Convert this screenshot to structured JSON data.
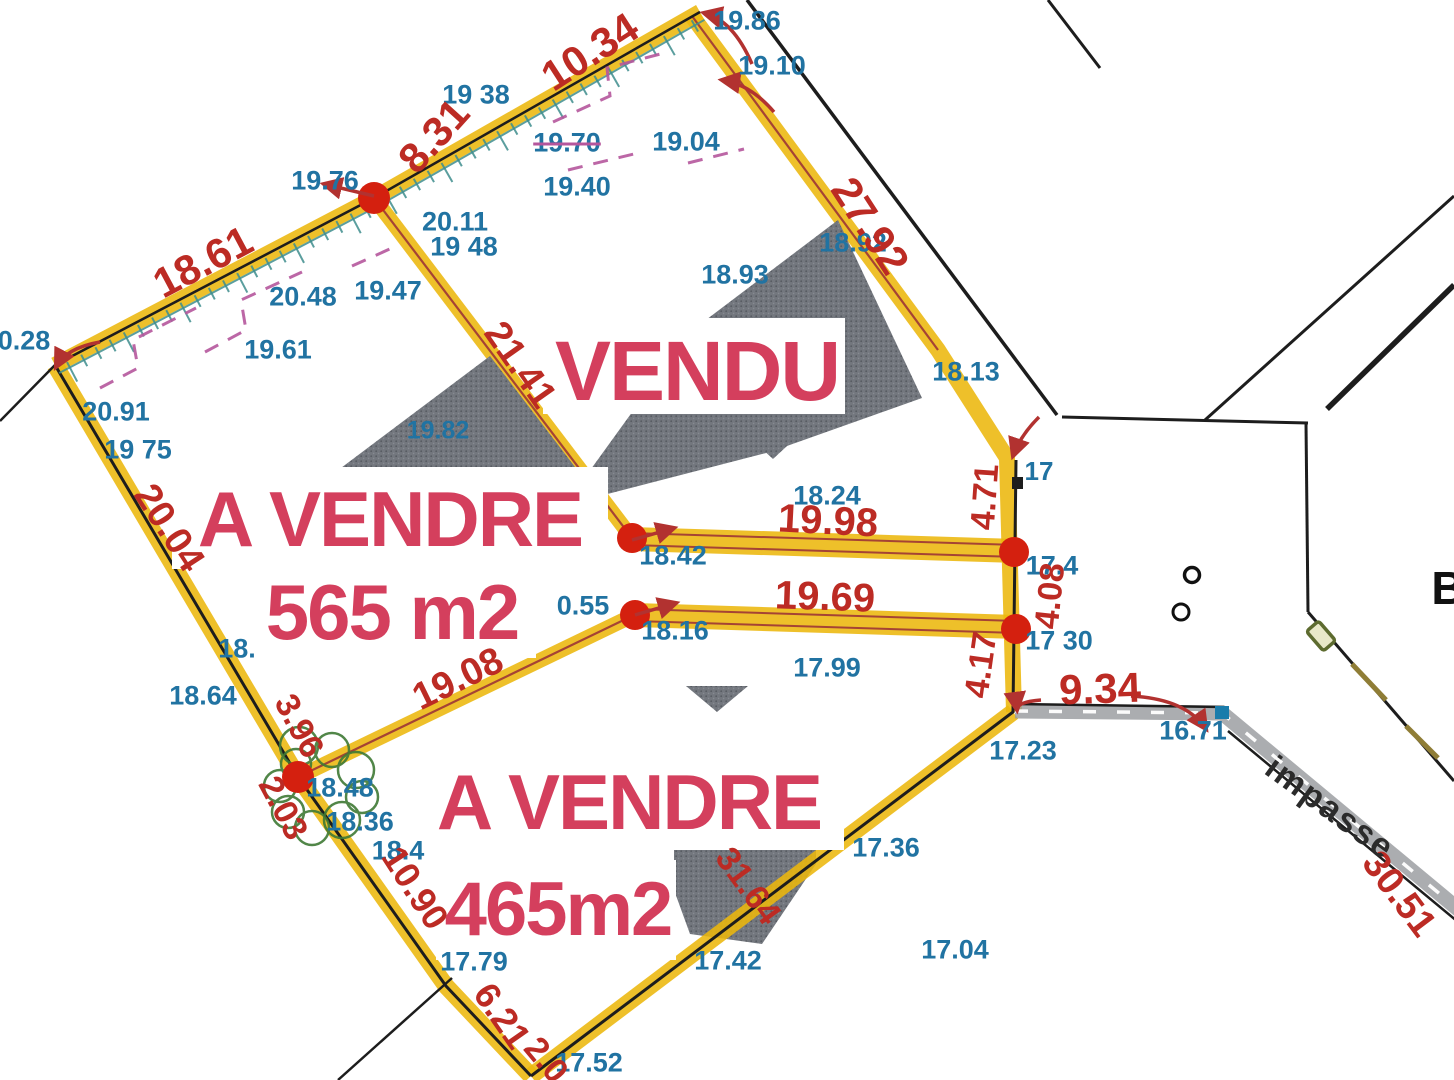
{
  "palette": {
    "boundary_yellow": "#ecb70d",
    "measure_red": "#bc2b24",
    "elevation_blue": "#2173a2",
    "overlay_pink": "#d43f5d",
    "hatch_teal": "#3f8e8e",
    "dash_magenta": "#b5569c",
    "building_gray": "#73777e",
    "road_gray": "#96999c",
    "tree_green": "#3f7a35",
    "vertex_dot_red": "#d4200f",
    "marker_blue": "#1a7cab"
  },
  "overlays": {
    "vendu": "VENDU",
    "parcel_565_status": "A VENDRE",
    "parcel_565_area": "565 m2",
    "parcel_465_status": "A VENDRE",
    "parcel_465_area": "465m2"
  },
  "street": {
    "impasse_label": "impasse",
    "edge_letter": "B"
  },
  "elevations": [
    {
      "t": "19.86",
      "x": 747,
      "y": 21
    },
    {
      "t": "19.10",
      "x": 772,
      "y": 66
    },
    {
      "t": "19 38",
      "x": 476,
      "y": 95
    },
    {
      "t": "19.70",
      "x": 567,
      "y": 143,
      "strike": true
    },
    {
      "t": "19.04",
      "x": 686,
      "y": 142
    },
    {
      "t": "19.40",
      "x": 577,
      "y": 187
    },
    {
      "t": "19.76",
      "x": 325,
      "y": 181
    },
    {
      "t": "20.11",
      "x": 455,
      "y": 222
    },
    {
      "t": "19 48",
      "x": 464,
      "y": 247
    },
    {
      "t": "20.48",
      "x": 303,
      "y": 297
    },
    {
      "t": "19.47",
      "x": 388,
      "y": 291
    },
    {
      "t": "19.61",
      "x": 278,
      "y": 350
    },
    {
      "t": "18.93",
      "x": 735,
      "y": 275
    },
    {
      "t": "18.92",
      "x": 853,
      "y": 243
    },
    {
      "t": "18.13",
      "x": 966,
      "y": 372
    },
    {
      "t": "17",
      "x": 1039,
      "y": 471,
      "s": 26
    },
    {
      "t": "20.91",
      "x": 116,
      "y": 412
    },
    {
      "t": "19 75",
      "x": 138,
      "y": 450
    },
    {
      "t": "19.82",
      "x": 438,
      "y": 431,
      "s": 25
    },
    {
      "t": "18.24",
      "x": 827,
      "y": 496
    },
    {
      "t": "18.42",
      "x": 673,
      "y": 556
    },
    {
      "t": "0.55",
      "x": 583,
      "y": 606
    },
    {
      "t": "18.16",
      "x": 675,
      "y": 631
    },
    {
      "t": "17.99",
      "x": 827,
      "y": 668
    },
    {
      "t": "17 30",
      "x": 1059,
      "y": 641
    },
    {
      "t": "17.4",
      "x": 1052,
      "y": 566
    },
    {
      "t": "18.",
      "x": 237,
      "y": 649
    },
    {
      "t": "18.64",
      "x": 203,
      "y": 696
    },
    {
      "t": "18.48",
      "x": 340,
      "y": 788
    },
    {
      "t": "18.36",
      "x": 360,
      "y": 822
    },
    {
      "t": "18.4",
      "x": 398,
      "y": 851
    },
    {
      "t": "17.79",
      "x": 474,
      "y": 962
    },
    {
      "t": "17.52",
      "x": 589,
      "y": 1063
    },
    {
      "t": "17.42",
      "x": 728,
      "y": 961
    },
    {
      "t": "17.36",
      "x": 886,
      "y": 848
    },
    {
      "t": "17.23",
      "x": 1023,
      "y": 751
    },
    {
      "t": "17.04",
      "x": 955,
      "y": 950
    },
    {
      "t": "16.71",
      "x": 1193,
      "y": 731
    },
    {
      "t": "0.28",
      "x": 24,
      "y": 341
    }
  ],
  "measurements": [
    {
      "t": "10.34",
      "x": 590,
      "y": 52,
      "r": -33,
      "s": 42
    },
    {
      "t": "8.31",
      "x": 434,
      "y": 136,
      "r": -48,
      "s": 42
    },
    {
      "t": "18.61",
      "x": 203,
      "y": 262,
      "r": -28,
      "s": 42
    },
    {
      "t": "27.92",
      "x": 870,
      "y": 226,
      "r": 57,
      "s": 42
    },
    {
      "t": "21.41",
      "x": 520,
      "y": 365,
      "r": 55,
      "s": 38
    },
    {
      "t": "19.98",
      "x": 828,
      "y": 521,
      "r": 3,
      "s": 40
    },
    {
      "t": "19.69",
      "x": 825,
      "y": 597,
      "r": 2,
      "s": 40
    },
    {
      "t": "19.08",
      "x": 458,
      "y": 679,
      "r": -26,
      "s": 38
    },
    {
      "t": "20.04",
      "x": 169,
      "y": 528,
      "r": 57,
      "s": 38
    },
    {
      "t": "4.71",
      "x": 985,
      "y": 497,
      "r": -86,
      "s": 34
    },
    {
      "t": "4.08",
      "x": 1050,
      "y": 596,
      "r": -84,
      "s": 34
    },
    {
      "t": "4.17",
      "x": 981,
      "y": 665,
      "r": -82,
      "s": 34
    },
    {
      "t": "9.34",
      "x": 1100,
      "y": 689,
      "r": -2,
      "s": 42
    },
    {
      "t": "3.96",
      "x": 299,
      "y": 726,
      "r": 62,
      "s": 34
    },
    {
      "t": "2.03",
      "x": 283,
      "y": 808,
      "r": 62,
      "s": 34
    },
    {
      "t": "10.90",
      "x": 415,
      "y": 888,
      "r": 57,
      "s": 36
    },
    {
      "t": "6.21",
      "x": 502,
      "y": 1016,
      "r": 55,
      "s": 36
    },
    {
      "t": "2.0",
      "x": 546,
      "y": 1060,
      "r": 50,
      "s": 34
    },
    {
      "t": "31.64",
      "x": 748,
      "y": 886,
      "r": 54,
      "s": 34
    },
    {
      "t": "30.51",
      "x": 1399,
      "y": 894,
      "r": 53,
      "s": 38
    }
  ]
}
